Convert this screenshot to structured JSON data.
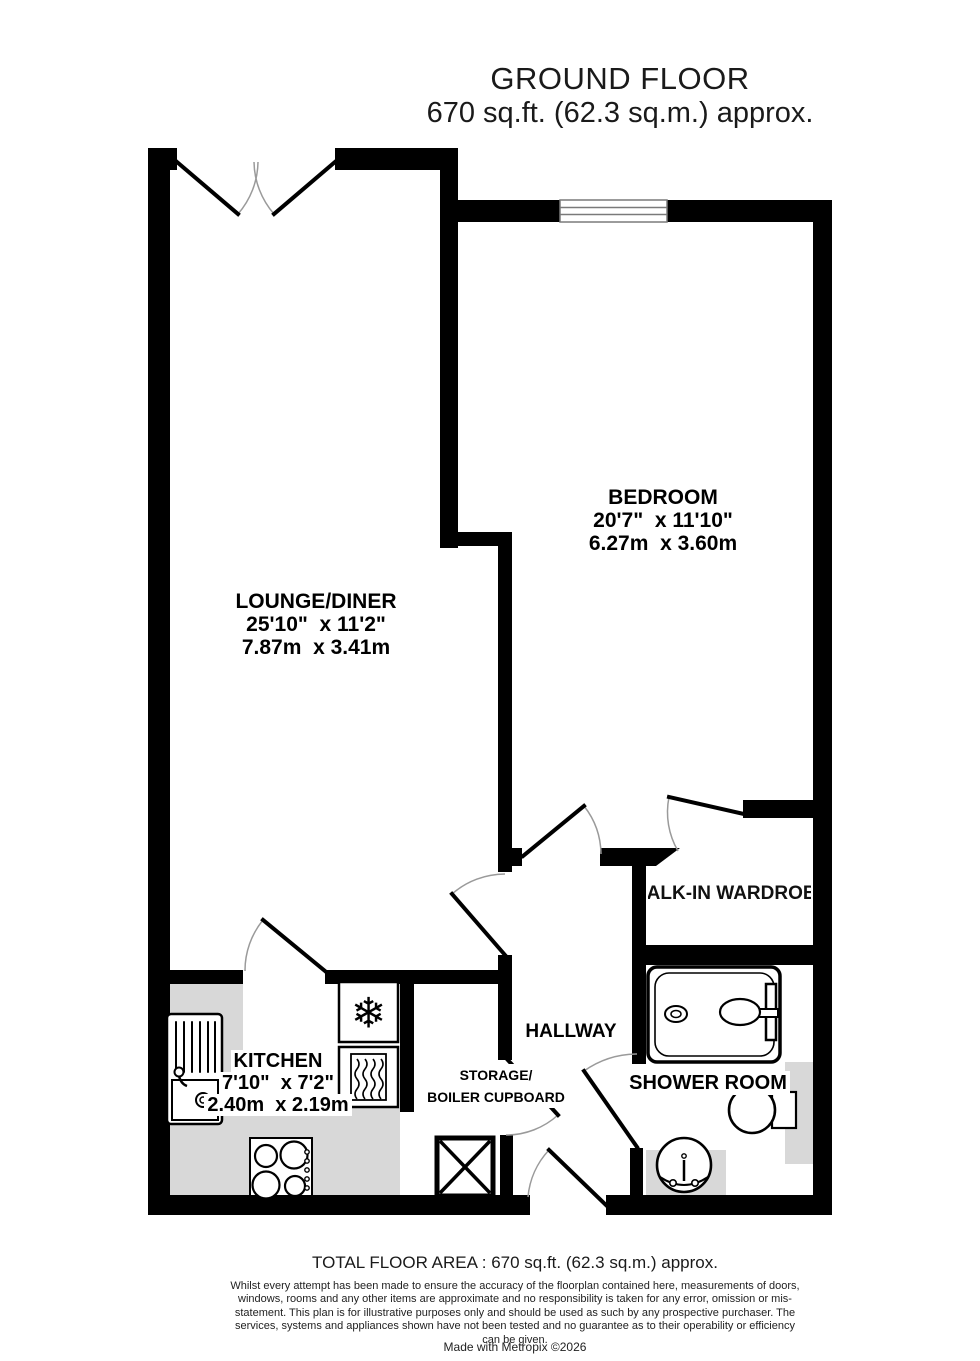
{
  "header": {
    "title": "GROUND FLOOR",
    "subtitle": "670 sq.ft. (62.3 sq.m.) approx."
  },
  "rooms": {
    "lounge": {
      "name": "LOUNGE/DINER",
      "dims_imperial": "25'10\"  x 11'2\"",
      "dims_metric": "7.87m  x 3.41m"
    },
    "bedroom": {
      "name": "BEDROOM",
      "dims_imperial": "20'7\"  x 11'10\"",
      "dims_metric": "6.27m  x 3.60m"
    },
    "kitchen": {
      "name": "KITCHEN",
      "dims_imperial": "7'10\"  x 7'2\"",
      "dims_metric": "2.40m  x 2.19m"
    },
    "hallway": {
      "name": "HALLWAY"
    },
    "storage": {
      "name_line1": "STORAGE/",
      "name_line2": "BOILER CUPBOARD"
    },
    "wardrobe": {
      "name": "WALK-IN WARDROBE"
    },
    "shower": {
      "name": "SHOWER ROOM"
    }
  },
  "fixtures": {
    "fridge_symbol": "snowflake",
    "snowflake_glyph": "❄"
  },
  "footer": {
    "total_area": "TOTAL FLOOR AREA : 670 sq.ft. (62.3 sq.m.) approx.",
    "disclaimer": "Whilst every attempt has been made to ensure the accuracy of the floorplan contained here, measurements of doors, windows, rooms and any other items are approximate and no responsibility is taken for any error, omission or mis-statement. This plan is for illustrative purposes only and should be used as such by any prospective purchaser. The services, systems and appliances shown have not been tested and no guarantee as to their operability or efficiency can be given.",
    "credit": "Made with Metropix ©2026"
  },
  "colors": {
    "wall": "#000000",
    "counter_gray": "#d8d8d8",
    "window_line": "#7a7a7a",
    "door_arc": "#9a9a9a"
  }
}
